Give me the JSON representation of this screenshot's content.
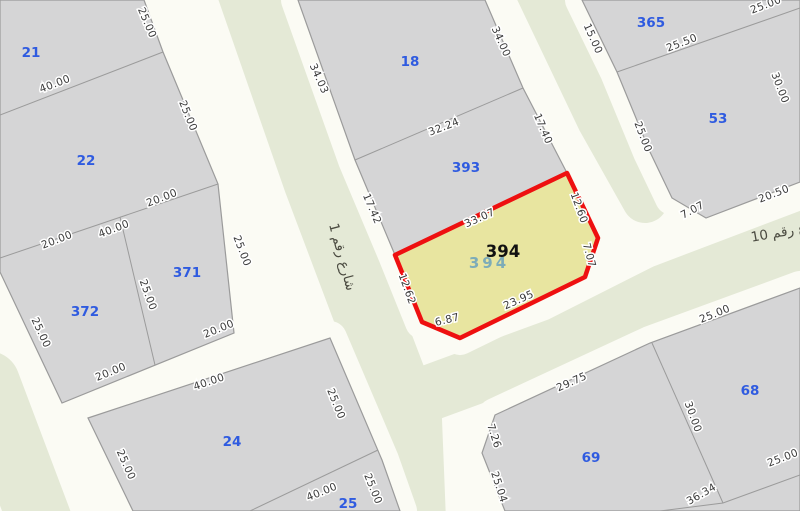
{
  "map": {
    "title": "cadastral-parcel-map",
    "colors": {
      "background": "#fbfbf4",
      "road_green": "#e4e9d6",
      "road_white": "#fbfbf4",
      "parcel_fill": "#d5d5d6",
      "parcel_edge": "#9b9b9b",
      "highlight_fill": "#e8e5a0",
      "highlight_edge": "#ee1010",
      "parcel_number_color": "#2f5be0",
      "dim_color": "#3a3a3a",
      "dim_halo": "#ffffff",
      "street_color": "#4a4a40",
      "highlight_label_color": "#111111",
      "highlight_sublabel_color": "#6ba3bd"
    },
    "roads": [
      {
        "name": "street-1",
        "points": [
          [
            251,
            -10
          ],
          [
            317,
            180
          ],
          [
            366,
            310
          ],
          [
            408,
            420
          ],
          [
            412,
            521
          ]
        ],
        "width": 68
      },
      {
        "name": "street-topright",
        "points": [
          [
            538,
            -10
          ],
          [
            600,
            120
          ],
          [
            645,
            200
          ]
        ],
        "width": 46
      },
      {
        "name": "street-10",
        "points": [
          [
            432,
            392
          ],
          [
            560,
            345
          ],
          [
            665,
            292
          ],
          [
            810,
            237
          ]
        ],
        "width": 56
      },
      {
        "name": "street-left-edge",
        "points": [
          [
            -12,
            383
          ],
          [
            40,
            521
          ]
        ],
        "width": 64
      }
    ],
    "blocks": [
      {
        "name": "block-21-22-371-372",
        "outline": [
          [
            0,
            0
          ],
          [
            144,
            0
          ],
          [
            163,
            52
          ],
          [
            218,
            184
          ],
          [
            234,
            333
          ],
          [
            62,
            403
          ],
          [
            0,
            272
          ]
        ],
        "inner": [
          [
            [
              0,
              115
            ],
            [
              163,
              52
            ]
          ],
          [
            [
              0,
              258
            ],
            [
              218,
              184
            ]
          ],
          [
            [
              120,
              217
            ],
            [
              155,
              365
            ]
          ]
        ]
      },
      {
        "name": "block-18-393-394",
        "outline": [
          [
            298,
            0
          ],
          [
            485,
            0
          ],
          [
            523,
            88
          ],
          [
            567,
            173
          ],
          [
            598,
            238
          ],
          [
            585,
            277
          ],
          [
            460,
            338
          ],
          [
            422,
            322
          ],
          [
            395,
            255
          ],
          [
            355,
            160
          ]
        ],
        "inner": [
          [
            [
              355,
              160
            ],
            [
              523,
              88
            ]
          ],
          [
            [
              395,
              255
            ],
            [
              567,
              173
            ]
          ]
        ]
      },
      {
        "name": "block-365-53",
        "outline": [
          [
            582,
            0
          ],
          [
            800,
            0
          ],
          [
            800,
            182
          ],
          [
            706,
            218
          ],
          [
            672,
            198
          ],
          [
            650,
            152
          ],
          [
            617,
            72
          ]
        ],
        "inner": [
          [
            [
              617,
              72
            ],
            [
              800,
              8
            ]
          ]
        ]
      },
      {
        "name": "block-24-25",
        "outline": [
          [
            88,
            418
          ],
          [
            330,
            338
          ],
          [
            382,
            460
          ],
          [
            400,
            511
          ],
          [
            133,
            511
          ]
        ],
        "inner": [
          [
            [
              378,
              450
            ],
            [
              250,
              511
            ]
          ]
        ]
      },
      {
        "name": "block-68-69",
        "outline": [
          [
            495,
            415
          ],
          [
            650,
            343
          ],
          [
            800,
            288
          ],
          [
            800,
            511
          ],
          [
            505,
            511
          ],
          [
            482,
            453
          ]
        ],
        "inner": [
          [
            [
              652,
              343
            ],
            [
              723,
              503
            ]
          ],
          [
            [
              660,
              511
            ],
            [
              723,
              503
            ],
            [
              800,
              475
            ]
          ]
        ]
      }
    ],
    "highlight": {
      "parcel_number": "394",
      "polygon": [
        [
          395,
          255
        ],
        [
          567,
          173
        ],
        [
          598,
          238
        ],
        [
          585,
          277
        ],
        [
          460,
          338
        ],
        [
          422,
          322
        ]
      ],
      "label": {
        "t": "394",
        "x": 503,
        "y": 257
      },
      "sub_label": {
        "t": "394",
        "x": 489,
        "y": 268
      }
    },
    "parcel_numbers": [
      {
        "t": "21",
        "x": 31,
        "y": 57
      },
      {
        "t": "22",
        "x": 86,
        "y": 165
      },
      {
        "t": "371",
        "x": 187,
        "y": 277
      },
      {
        "t": "372",
        "x": 85,
        "y": 316
      },
      {
        "t": "24",
        "x": 232,
        "y": 446
      },
      {
        "t": "25",
        "x": 348,
        "y": 508
      },
      {
        "t": "18",
        "x": 410,
        "y": 66
      },
      {
        "t": "393",
        "x": 466,
        "y": 172
      },
      {
        "t": "365",
        "x": 651,
        "y": 27
      },
      {
        "t": "53",
        "x": 718,
        "y": 123
      },
      {
        "t": "68",
        "x": 750,
        "y": 395
      },
      {
        "t": "69",
        "x": 591,
        "y": 462
      }
    ],
    "dimension_labels": [
      {
        "t": "40.00",
        "x": 56,
        "y": 87,
        "r": -21
      },
      {
        "t": "25.00",
        "x": 144,
        "y": 24,
        "r": 67
      },
      {
        "t": "25.00",
        "x": 185,
        "y": 117,
        "r": 68
      },
      {
        "t": "20.00",
        "x": 58,
        "y": 243,
        "r": -21
      },
      {
        "t": "40.00",
        "x": 115,
        "y": 232,
        "r": -21
      },
      {
        "t": "20.00",
        "x": 163,
        "y": 201,
        "r": -21
      },
      {
        "t": "25.00",
        "x": 239,
        "y": 252,
        "r": 69
      },
      {
        "t": "25.00",
        "x": 145,
        "y": 296,
        "r": 70
      },
      {
        "t": "20.00",
        "x": 220,
        "y": 332,
        "r": -22
      },
      {
        "t": "20.00",
        "x": 112,
        "y": 375,
        "r": -22
      },
      {
        "t": "25.00",
        "x": 38,
        "y": 334,
        "r": 65
      },
      {
        "t": "40.00",
        "x": 210,
        "y": 385,
        "r": -19
      },
      {
        "t": "25.00",
        "x": 123,
        "y": 466,
        "r": 66
      },
      {
        "t": "25.00",
        "x": 333,
        "y": 405,
        "r": 68
      },
      {
        "t": "40.00",
        "x": 323,
        "y": 495,
        "r": -22
      },
      {
        "t": "25.00",
        "x": 370,
        "y": 490,
        "r": 68
      },
      {
        "t": "34.03",
        "x": 316,
        "y": 80,
        "r": 66
      },
      {
        "t": "34.00",
        "x": 498,
        "y": 43,
        "r": 66
      },
      {
        "t": "32.24",
        "x": 445,
        "y": 130,
        "r": -21
      },
      {
        "t": "17.42",
        "x": 369,
        "y": 210,
        "r": 67
      },
      {
        "t": "17.40",
        "x": 540,
        "y": 130,
        "r": 67
      },
      {
        "t": "33.07",
        "x": 481,
        "y": 221,
        "r": -24
      },
      {
        "t": "12.60",
        "x": 576,
        "y": 209,
        "r": 70
      },
      {
        "t": "7.07",
        "x": 586,
        "y": 256,
        "r": 75
      },
      {
        "t": "23.95",
        "x": 520,
        "y": 303,
        "r": -24
      },
      {
        "t": "6.87",
        "x": 448,
        "y": 323,
        "r": -14
      },
      {
        "t": "12.62",
        "x": 404,
        "y": 290,
        "r": 70
      },
      {
        "t": "15.00",
        "x": 590,
        "y": 40,
        "r": 66
      },
      {
        "t": "25.50",
        "x": 683,
        "y": 46,
        "r": -21
      },
      {
        "t": "25.00",
        "x": 767,
        "y": 8,
        "r": -21
      },
      {
        "t": "25.00",
        "x": 640,
        "y": 138,
        "r": 69
      },
      {
        "t": "30.00",
        "x": 777,
        "y": 89,
        "r": 69
      },
      {
        "t": "20.50",
        "x": 775,
        "y": 197,
        "r": -21
      },
      {
        "t": "7.07",
        "x": 694,
        "y": 213,
        "r": -28
      },
      {
        "t": "29.75",
        "x": 573,
        "y": 385,
        "r": -24
      },
      {
        "t": "7.26",
        "x": 491,
        "y": 437,
        "r": 72
      },
      {
        "t": "25.04",
        "x": 496,
        "y": 488,
        "r": 72
      },
      {
        "t": "30.00",
        "x": 690,
        "y": 418,
        "r": 70
      },
      {
        "t": "25.00",
        "x": 716,
        "y": 317,
        "r": -22
      },
      {
        "t": "25.00",
        "x": 784,
        "y": 461,
        "r": -21
      },
      {
        "t": "36.34",
        "x": 703,
        "y": 497,
        "r": -30
      }
    ],
    "street_labels": [
      {
        "t": "شارع رقم 1",
        "x": 338,
        "y": 258,
        "r": 75
      },
      {
        "t": "شارع رقم 10",
        "x": 790,
        "y": 235,
        "r": -10
      }
    ]
  }
}
